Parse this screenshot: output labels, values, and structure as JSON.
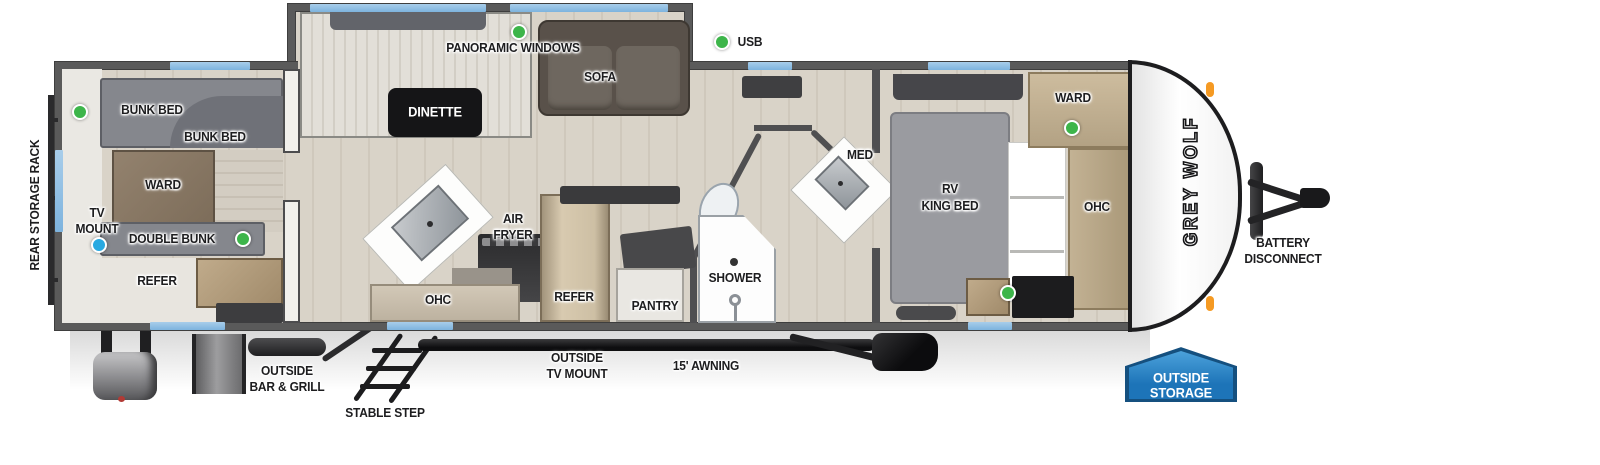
{
  "legend": {
    "usb": "USB"
  },
  "brand": {
    "logo": "GREY WOLF"
  },
  "rear_room": {
    "rack": "REAR STORAGE RACK",
    "bunk_bed_top": "BUNK BED",
    "bunk_bed_lower": "BUNK BED",
    "ward": "WARD",
    "tv_mount_l1": "TV",
    "tv_mount_l2": "MOUNT",
    "double_bunk": "DOUBLE BUNK",
    "refer": "REFER"
  },
  "living": {
    "panoramic_windows": "PANORAMIC WINDOWS",
    "dinette": "DINETTE",
    "sofa": "SOFA"
  },
  "kitchen": {
    "air_fryer_l1": "AIR",
    "air_fryer_l2": "FRYER",
    "ohc": "OHC",
    "refer": "REFER",
    "pantry": "PANTRY"
  },
  "bath": {
    "shower": "SHOWER",
    "med": "MED"
  },
  "bedroom": {
    "bed_l1": "RV",
    "bed_l2": "KING BED",
    "ward": "WARD",
    "ohc": "OHC"
  },
  "exterior": {
    "battery_l1": "BATTERY",
    "battery_l2": "DISCONNECT",
    "outside_storage_l1": "OUTSIDE",
    "outside_storage_l2": "STORAGE",
    "bar_grill_l1": "OUTSIDE",
    "bar_grill_l2": "BAR & GRILL",
    "stable_step": "STABLE STEP",
    "outside_tv_l1": "OUTSIDE",
    "outside_tv_l2": "TV MOUNT",
    "awning": "15' AWNING"
  },
  "colors": {
    "wall_gray": "#5a5a5a",
    "window_blue": "#85b8e2",
    "usb_green": "#3db54a",
    "tv_mount_blue": "#29a9e1",
    "badge_blue": "#2178bf",
    "marker_orange": "#f59a23"
  }
}
